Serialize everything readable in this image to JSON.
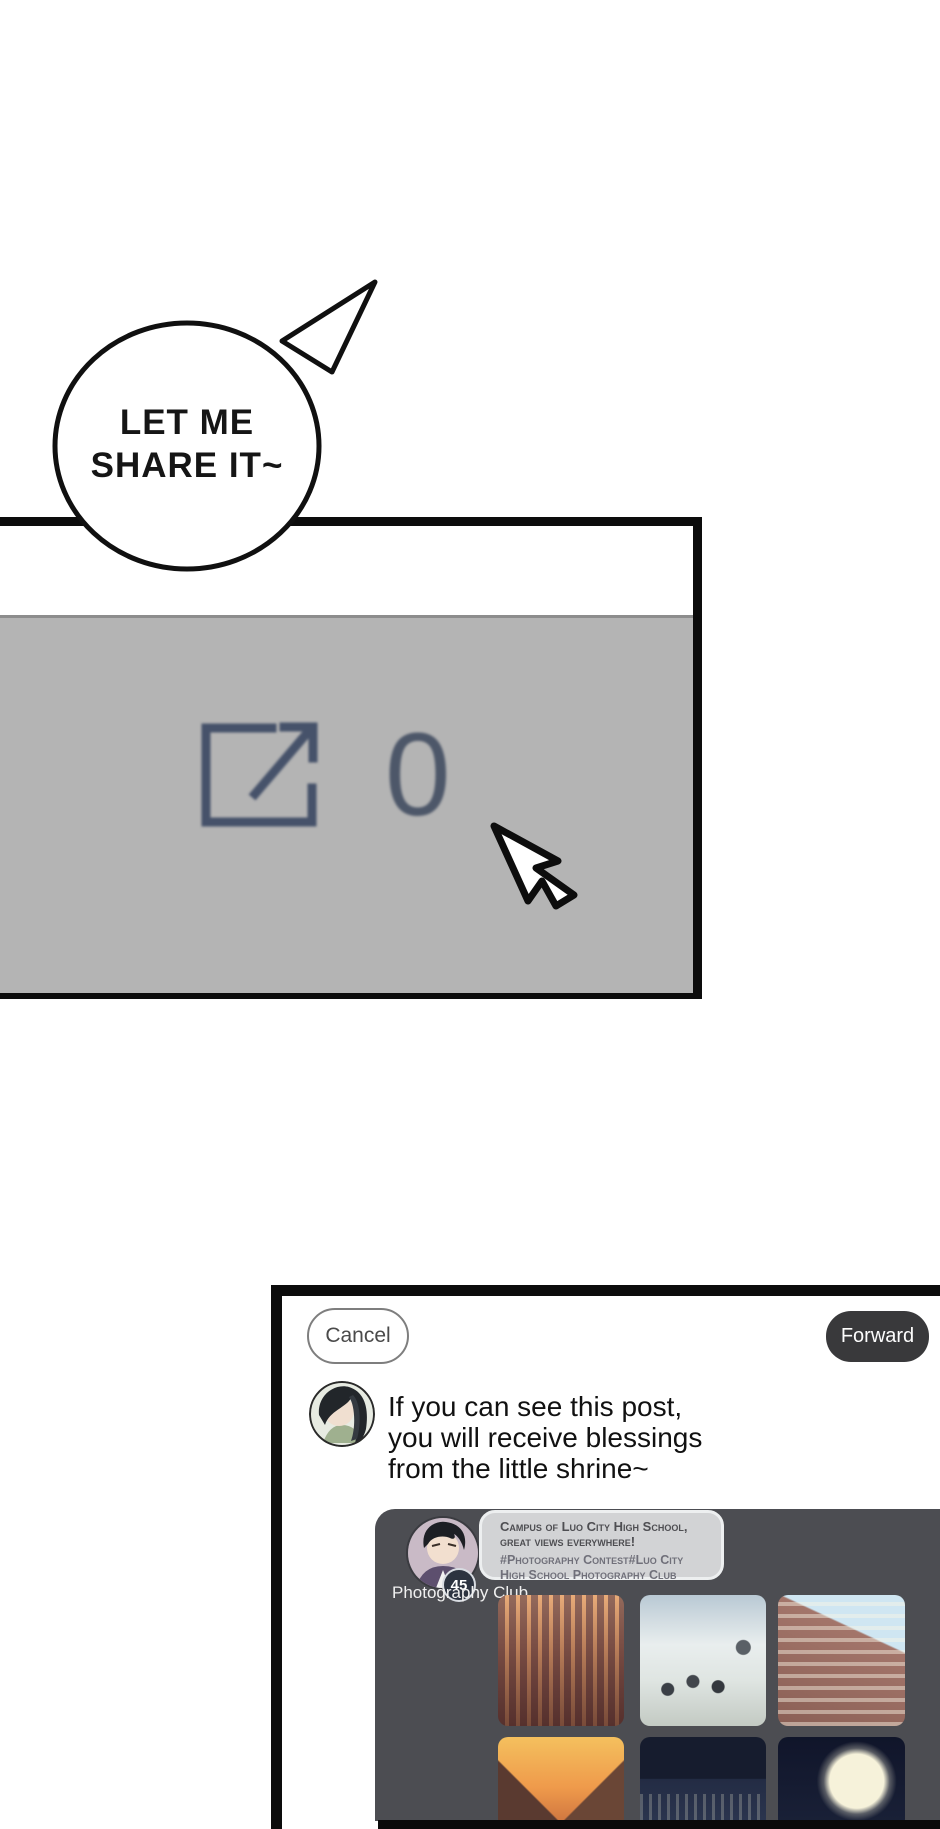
{
  "comic": {
    "speech_bubble": {
      "line1": "LET ME",
      "line2": "SHARE IT~"
    },
    "share_panel": {
      "share_count": "0",
      "icon": "share-forward-icon",
      "cursor": "mouse-cursor-icon",
      "panel_bg_color": "#b4b4b4",
      "icon_color": "#46526a"
    }
  },
  "forward_sheet": {
    "cancel_label": "Cancel",
    "forward_label": "Forward",
    "forward_button_color": "#39393b",
    "message_lines": [
      "If you can see this post,",
      "you will receive blessings",
      "from the little shrine~"
    ],
    "post_card": {
      "card_bg_color": "#4c4d52",
      "poster_name": "Photography Club",
      "poster_badge": "45",
      "caption_lines": [
        "Campus of Luo City High School,",
        "great views everywhere!"
      ],
      "hashtag_lines": [
        "#Photography Contest#Luo City",
        "High School Photography Club"
      ],
      "photos": [
        "sunset-temple-building",
        "classroom-scene",
        "school-building-blue-sky",
        "sunset-sky-rooftop",
        "night-school-building",
        "full-moon-night-sky"
      ]
    }
  }
}
